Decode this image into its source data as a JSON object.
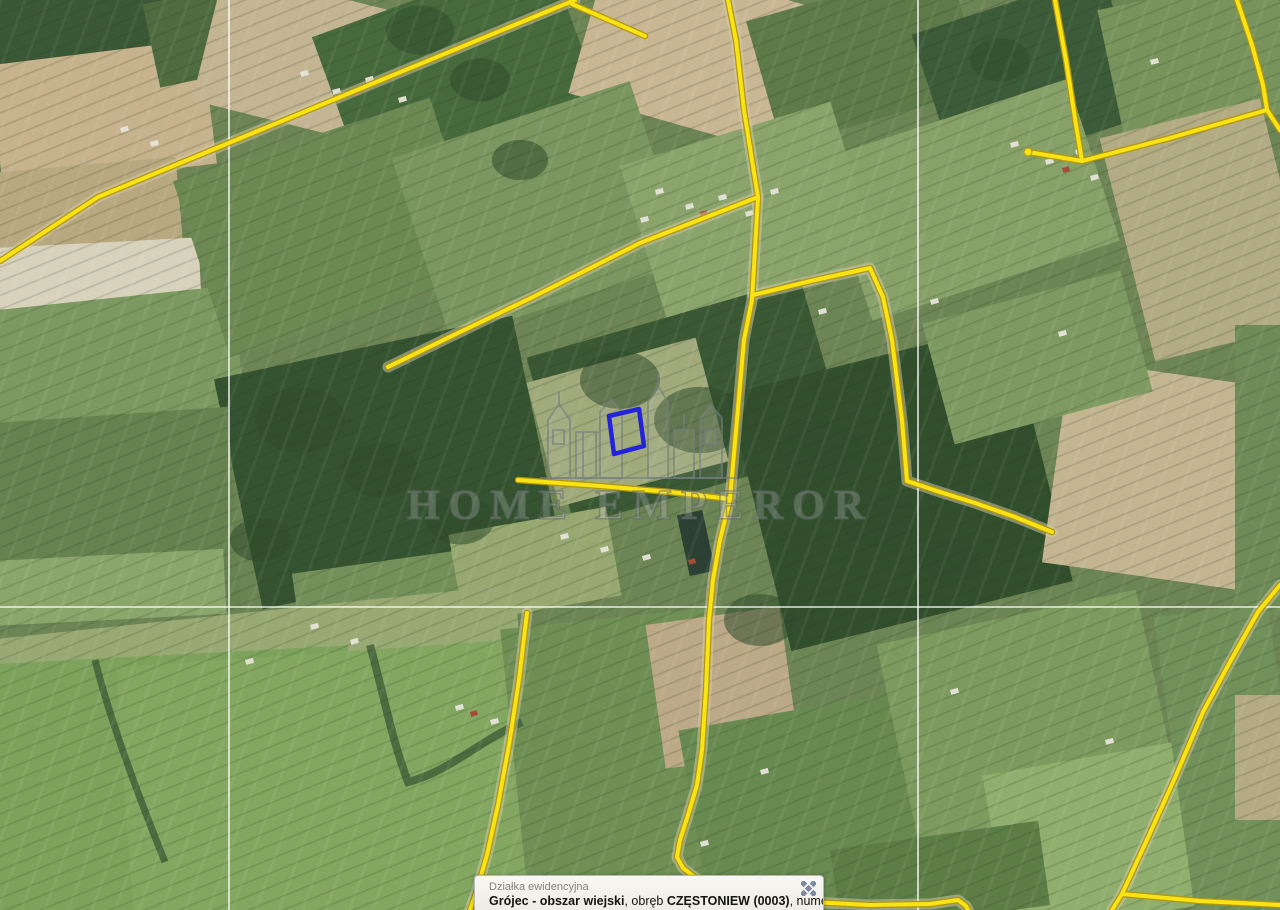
{
  "app": {
    "type": "cadastral-map-viewer"
  },
  "map": {
    "watermark_text": "HOME EMPEROR",
    "colors": {
      "boundary": "#f8e414",
      "boundary_edge": "#b3950f",
      "road_under": "#d6cdb0",
      "parcel_highlight": "#2323dc",
      "grid_line": "rgba(255,255,255,0.85)"
    },
    "grid": {
      "vertical_x": [
        229,
        918
      ],
      "horizontal_y": [
        607
      ]
    },
    "parcel_highlight_points": [
      [
        609,
        416
      ],
      [
        639,
        409
      ],
      [
        644,
        446
      ],
      [
        614,
        454
      ]
    ],
    "boundary_lines": [
      [
        [
          0,
          261
        ],
        [
          98,
          197
        ],
        [
          575,
          0
        ]
      ],
      [
        [
          572,
          4
        ],
        [
          645,
          36
        ]
      ],
      [
        [
          728,
          0
        ],
        [
          736,
          40
        ],
        [
          744,
          110
        ],
        [
          752,
          160
        ],
        [
          758,
          197
        ],
        [
          755,
          250
        ],
        [
          752,
          300
        ],
        [
          744,
          340
        ],
        [
          737,
          420
        ],
        [
          730,
          499
        ],
        [
          720,
          540
        ],
        [
          713,
          580
        ],
        [
          709,
          620
        ],
        [
          706,
          690
        ],
        [
          702,
          750
        ],
        [
          697,
          785
        ],
        [
          688,
          815
        ],
        [
          680,
          840
        ],
        [
          677,
          857
        ],
        [
          683,
          868
        ],
        [
          697,
          879
        ],
        [
          722,
          888
        ],
        [
          760,
          896
        ],
        [
          810,
          902
        ],
        [
          870,
          905
        ],
        [
          930,
          904
        ],
        [
          958,
          900
        ],
        [
          966,
          906
        ],
        [
          968,
          910
        ]
      ],
      [
        [
          758,
          197
        ],
        [
          640,
          243
        ],
        [
          533,
          297
        ],
        [
          460,
          332
        ],
        [
          388,
          367
        ]
      ],
      [
        [
          518,
          480
        ],
        [
          600,
          486
        ],
        [
          670,
          492
        ],
        [
          730,
          499
        ]
      ],
      [
        [
          753,
          295
        ],
        [
          815,
          280
        ],
        [
          870,
          268
        ],
        [
          883,
          297
        ],
        [
          892,
          340
        ],
        [
          902,
          420
        ],
        [
          907,
          481
        ],
        [
          940,
          492
        ],
        [
          975,
          503
        ],
        [
          1015,
          517
        ],
        [
          1052,
          532
        ]
      ],
      [
        [
          1055,
          0
        ],
        [
          1066,
          60
        ],
        [
          1076,
          125
        ],
        [
          1082,
          161
        ]
      ],
      [
        [
          1082,
          161
        ],
        [
          1028,
          152
        ]
      ],
      [
        [
          1082,
          161
        ],
        [
          1170,
          138
        ],
        [
          1267,
          110
        ]
      ],
      [
        [
          1237,
          0
        ],
        [
          1252,
          45
        ],
        [
          1263,
          85
        ],
        [
          1267,
          110
        ]
      ],
      [
        [
          1267,
          110
        ],
        [
          1280,
          130
        ]
      ],
      [
        [
          527,
          613
        ],
        [
          519,
          680
        ],
        [
          509,
          745
        ],
        [
          498,
          805
        ],
        [
          487,
          855
        ],
        [
          476,
          893
        ],
        [
          470,
          910
        ]
      ],
      [
        [
          1280,
          585
        ],
        [
          1258,
          612
        ],
        [
          1230,
          662
        ],
        [
          1203,
          712
        ],
        [
          1174,
          780
        ],
        [
          1146,
          842
        ],
        [
          1122,
          894
        ],
        [
          1112,
          910
        ]
      ],
      [
        [
          1122,
          894
        ],
        [
          1200,
          901
        ],
        [
          1280,
          905
        ]
      ]
    ]
  },
  "popup": {
    "title": "Działka ewidencyjna",
    "body_segments": [
      {
        "text": "Grójec - obszar wiejski",
        "bold": true
      },
      {
        "text": ", obręb ",
        "bold": false
      },
      {
        "text": "CZĘSTONIEW (0003)",
        "bold": true
      },
      {
        "text": ", numer dz.50/3",
        "bold": false
      }
    ],
    "close_icon": "close-icon",
    "close_icon_color": "#7d89a2"
  }
}
